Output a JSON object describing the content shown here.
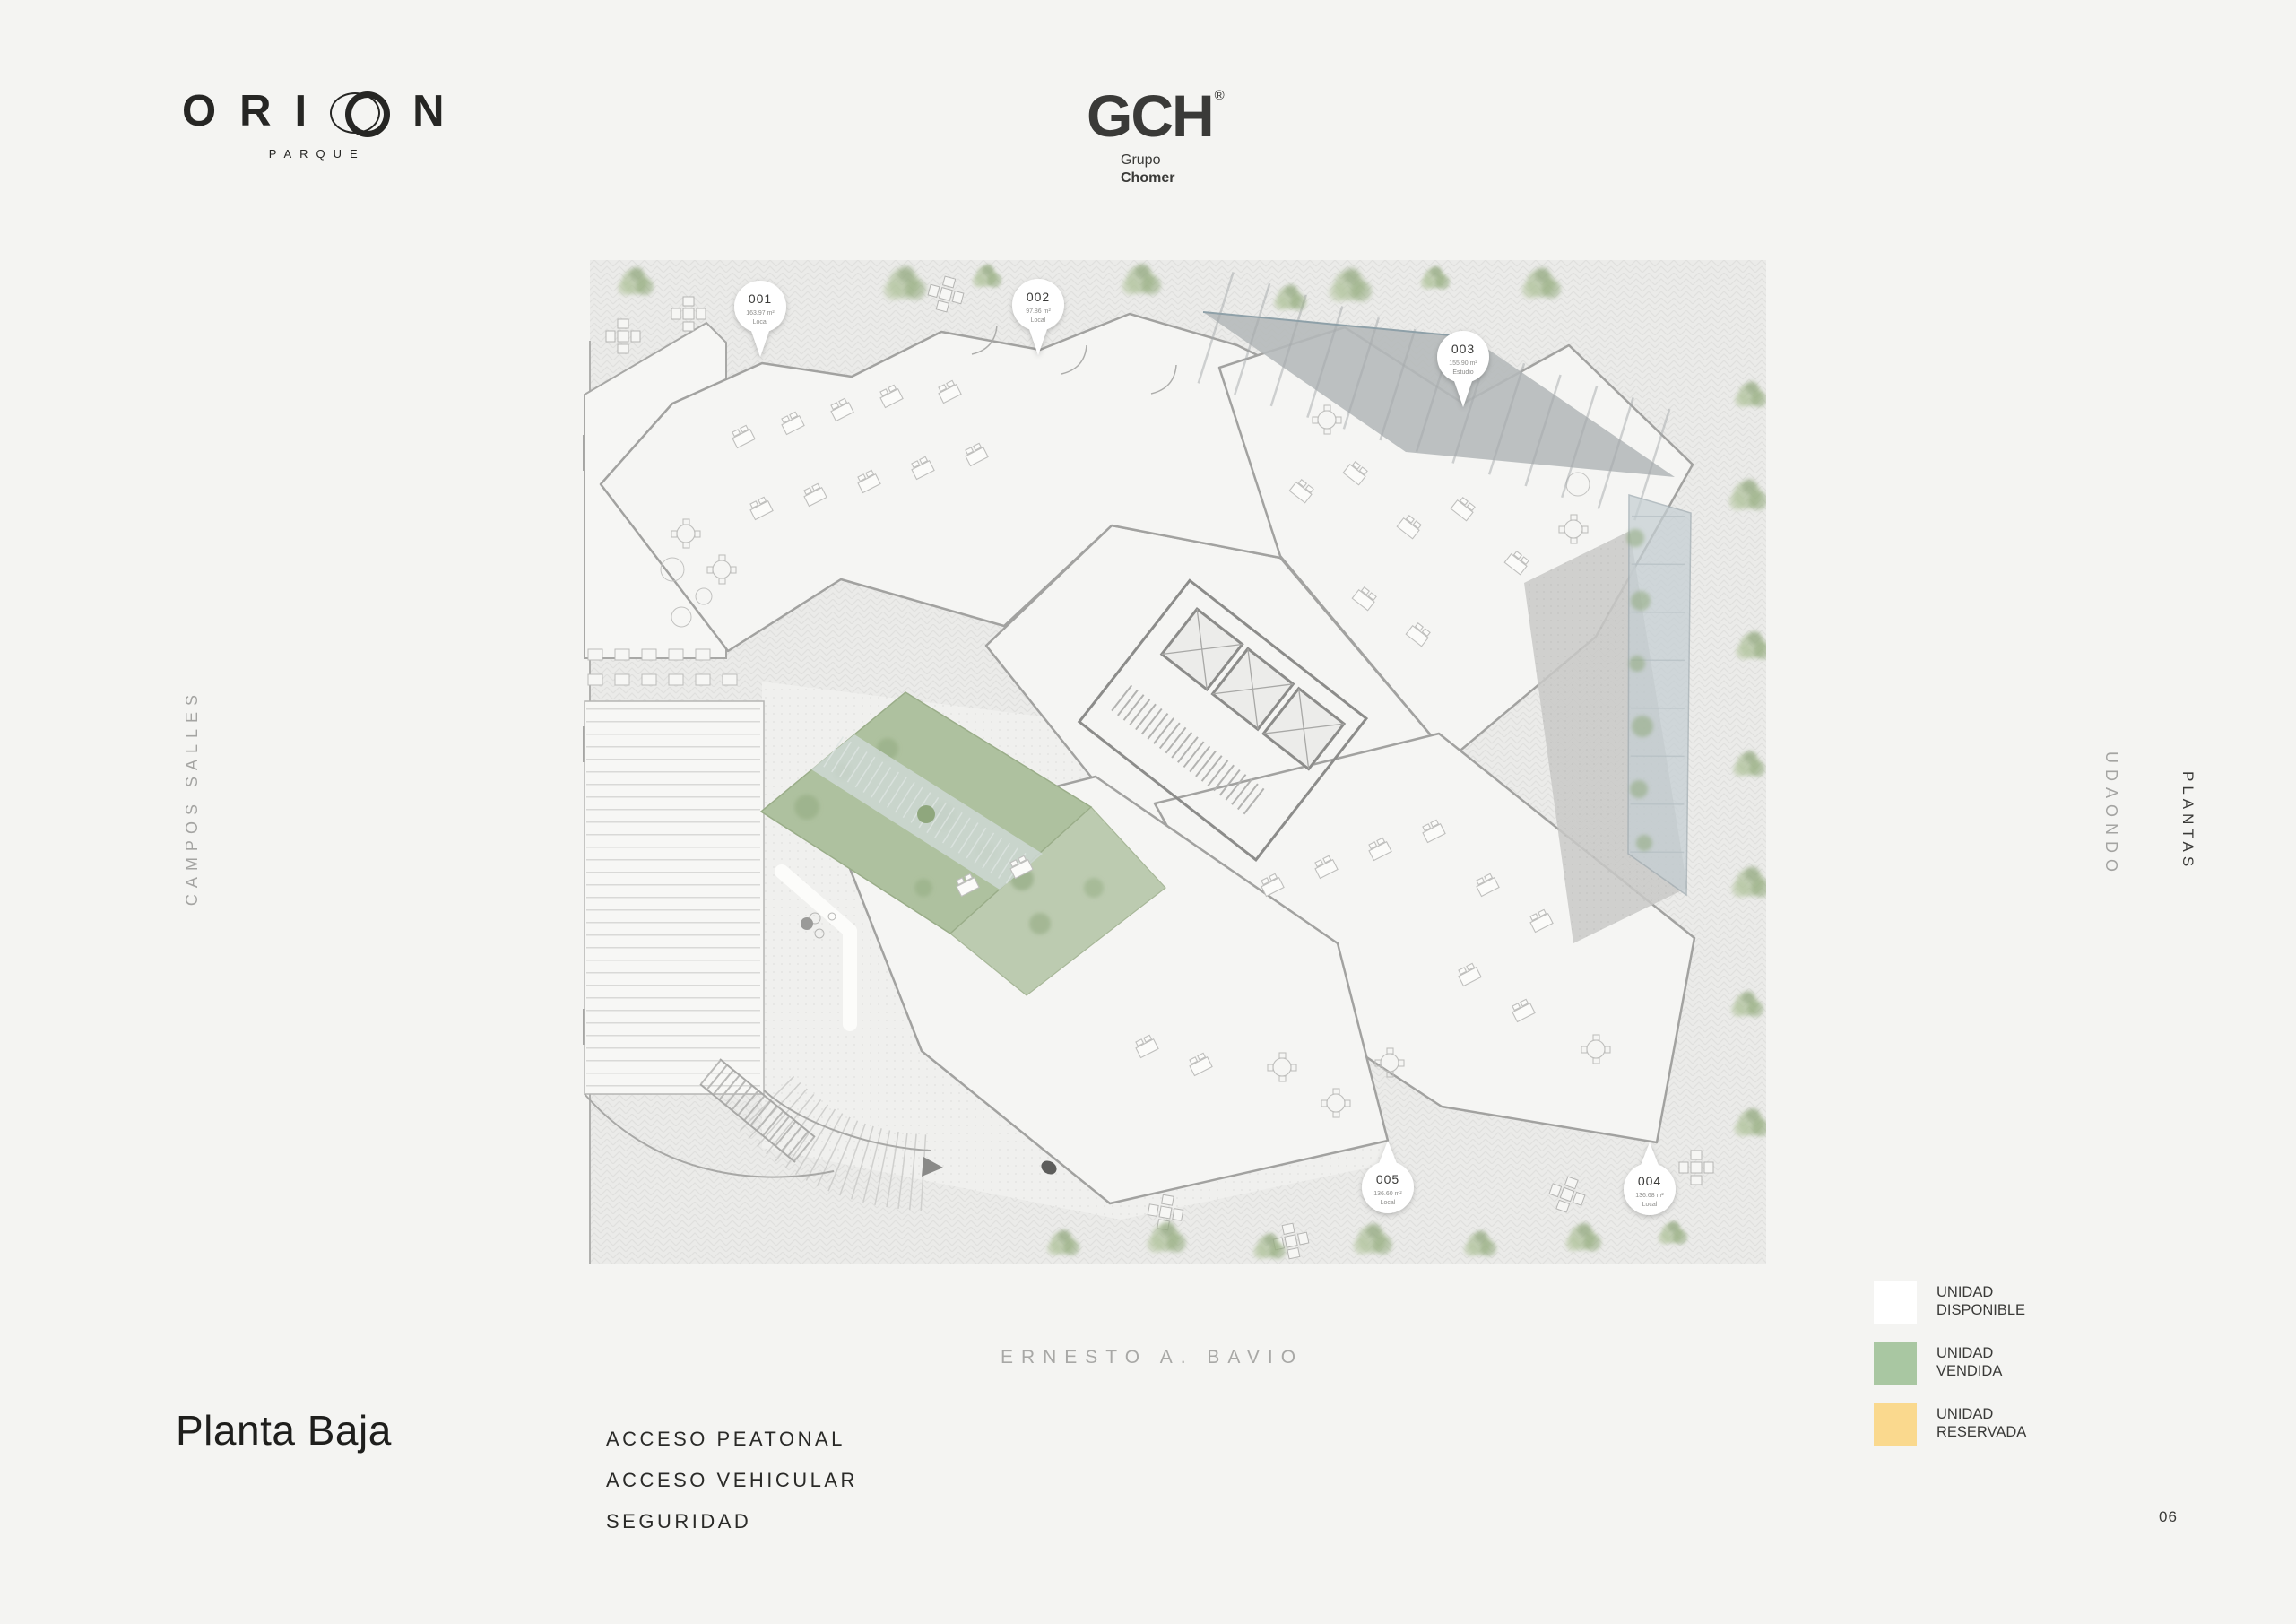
{
  "page": {
    "page_number": "06",
    "background": "#f4f4f2"
  },
  "header": {
    "brand": {
      "letters_pre": "ORI",
      "letters_post": "N",
      "subtitle": "PARQUE"
    },
    "developer": {
      "name": "GCH",
      "registered": "®",
      "line1": "Grupo",
      "line2": "Chomer"
    }
  },
  "streets": {
    "left": "CAMPOS SALLES",
    "right": "UDAONDO",
    "bottom": "ERNESTO A. BAVIO"
  },
  "side_label": "PLANTAS",
  "plan": {
    "title": "Planta Baja",
    "access_items": [
      "ACCESO PEATONAL",
      "ACCESO VEHICULAR",
      "SEGURIDAD"
    ],
    "units": [
      {
        "id": "001",
        "area": "163.97 m²",
        "type": "Local"
      },
      {
        "id": "002",
        "area": "97.86 m²",
        "type": "Local"
      },
      {
        "id": "003",
        "area": "155.90 m²",
        "type": "Estudio"
      },
      {
        "id": "004",
        "area": "136.68 m²",
        "type": "Local"
      },
      {
        "id": "005",
        "area": "136.60 m²",
        "type": "Local"
      }
    ]
  },
  "legend": [
    {
      "line1": "UNIDAD",
      "line2": "DISPONIBLE",
      "color": "#ffffff"
    },
    {
      "line1": "UNIDAD",
      "line2": "VENDIDA",
      "color": "#a9c7a2"
    },
    {
      "line1": "UNIDAD",
      "line2": "RESERVADA",
      "color": "#fad98e"
    }
  ],
  "colors": {
    "available": "#ffffff",
    "sold": "#a9c7a2",
    "reserved": "#fad98e"
  }
}
